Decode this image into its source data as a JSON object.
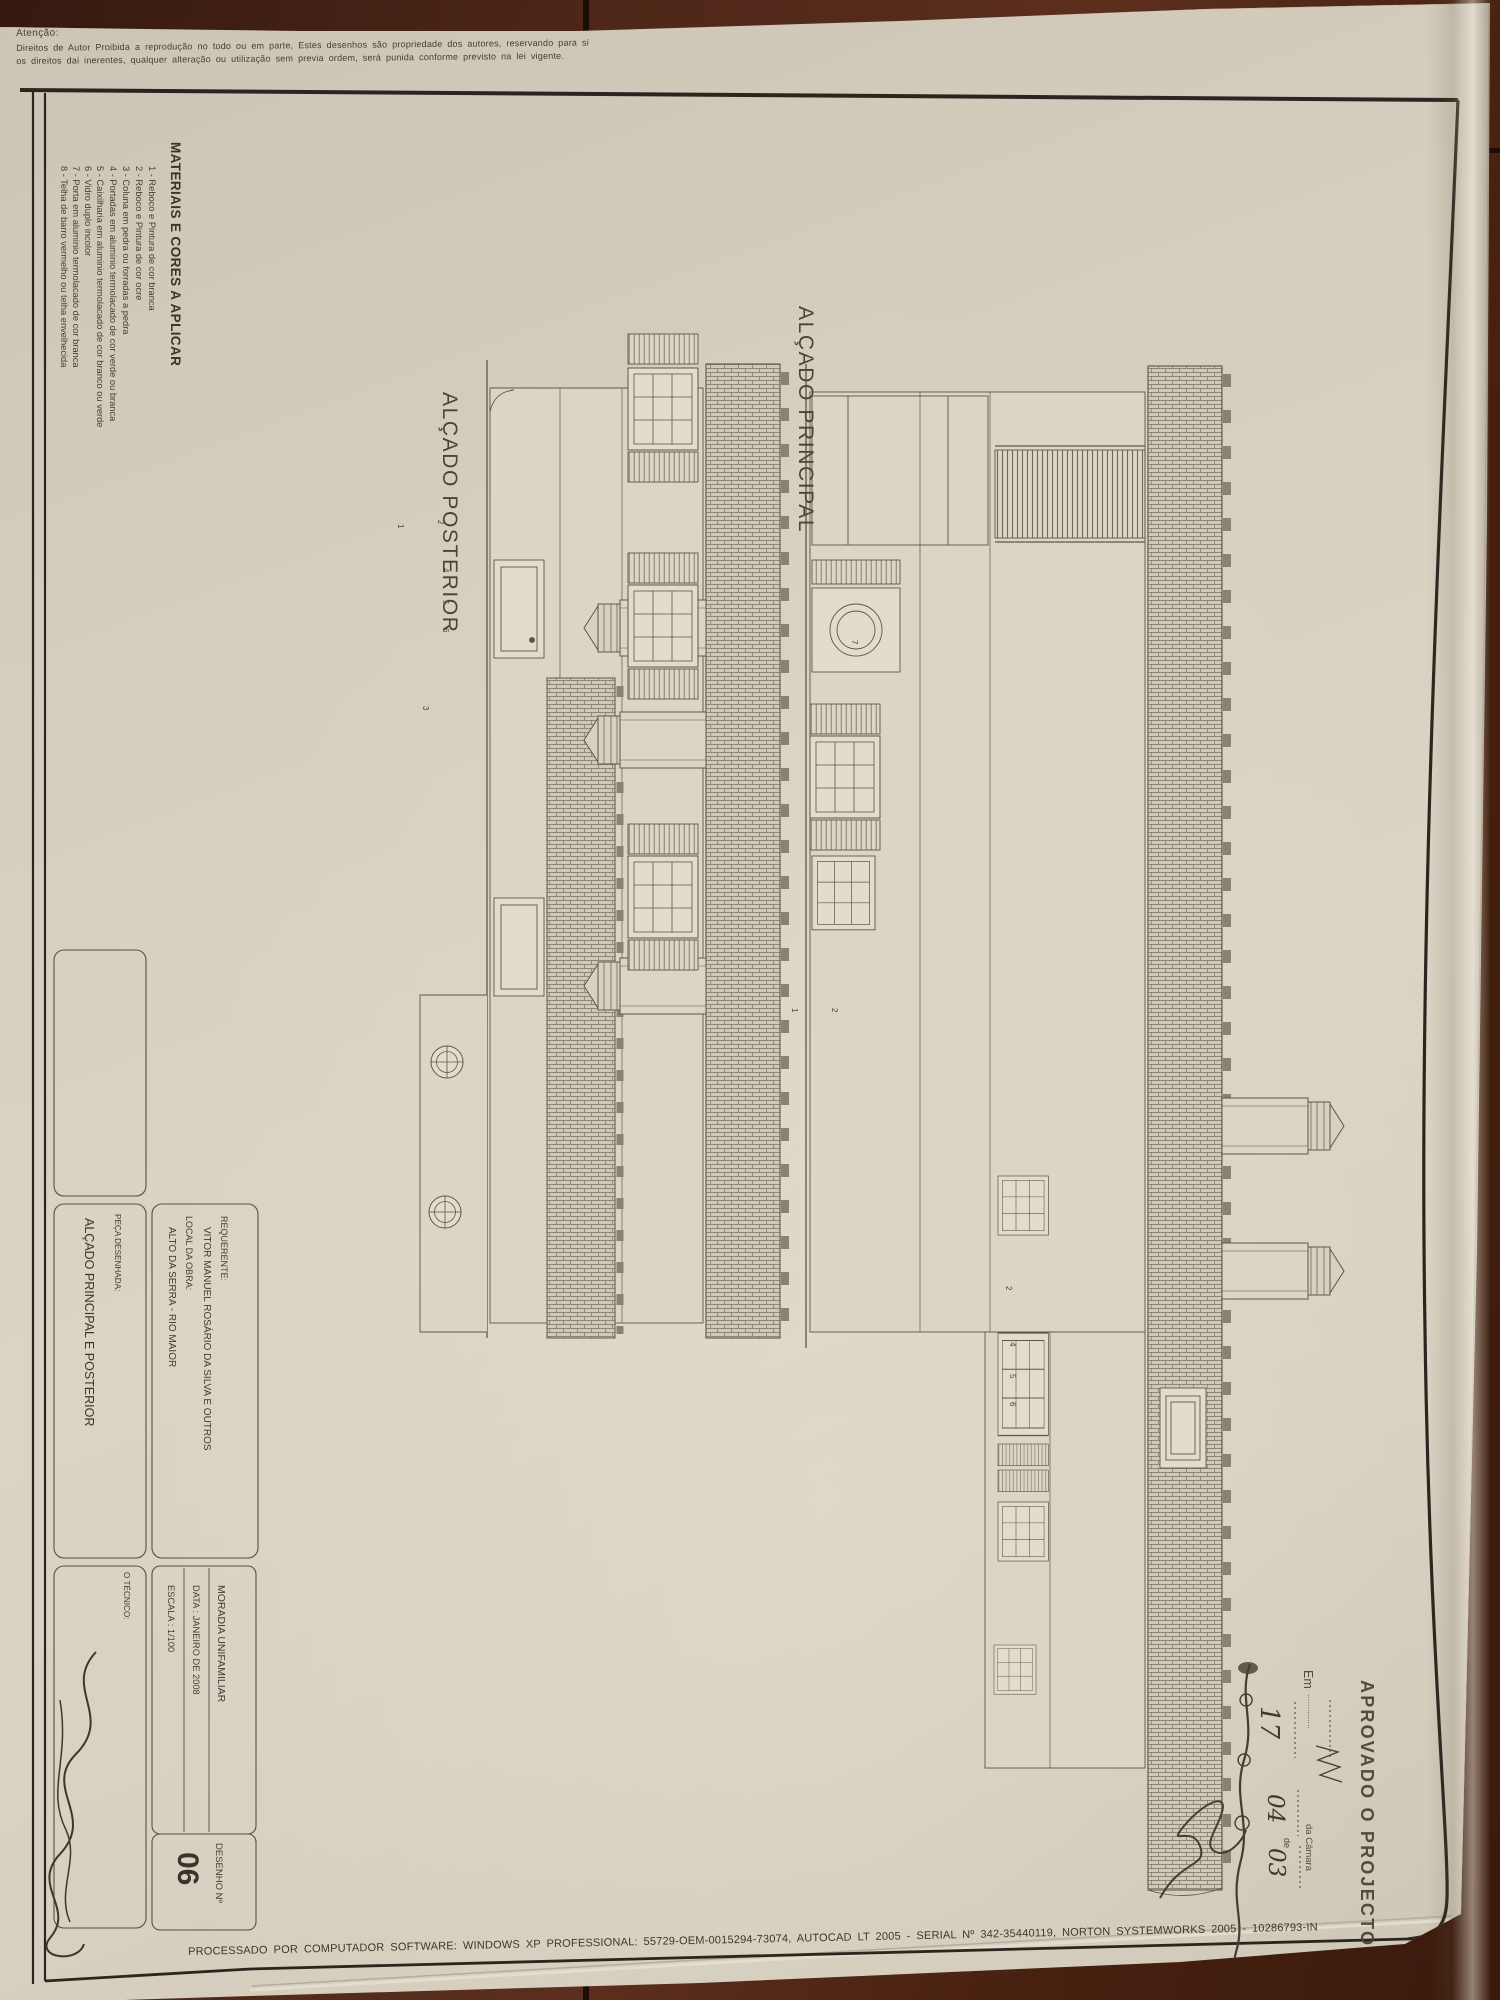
{
  "colors": {
    "paper": "#d7d0c1",
    "wood": "#4e2718",
    "ink": "#3e382f",
    "frame": "#2b2520",
    "stamp_ink": "#474136"
  },
  "copyright": {
    "heading": "Atenção:",
    "line1": "Direitos de Autor Proibida a reprodução no todo ou em parte, Estes desenhos são propriedade dos autores, reservando para si",
    "line2": "os direitos dai inerentes, qualquer alteração ou utilização sem previa ordem, será punida conforme previsto na lei vigente."
  },
  "materials": {
    "title": "MATERIAIS E CORES A APLICAR",
    "items": [
      "1 - Reboco e Pintura de cor branca",
      "2 - Reboco e Pintura de cor ocre",
      "3 - Coluna em pedra ou forradas a pedra",
      "4 - Portadas em aluminio termolacado de cor verde ou branca",
      "5 - Caixilharia em aluminio termolacado de cor branco ou verde",
      "6 - Vidro duplo incolor",
      "7 - Porta em aluminio termolacado de cor branca",
      "8 - Telha de barro vermelho ou telha envelhecida"
    ]
  },
  "elevations": {
    "posterior_label": "ALÇADO POSTERIOR",
    "principal_label": "ALÇADO PRINCIPAL"
  },
  "titleblock": {
    "requerente_label": "REQUERENTE:",
    "requerente": "VITOR MANUEL ROSÁRIO DA SILVA E OUTROS",
    "local_label": "LOCAL DA OBRA:",
    "local": "ALTO DA SERRA - RIO MAIOR",
    "project": "MORADIA UNIFAMILIAR",
    "date": "DATA : JANEIRO DE 2008",
    "scale": "ESCALA : 1/100",
    "peca_label": "PEÇA DESENHADA:",
    "peca": "ALÇADO PRINCIPAL E POSTERIOR",
    "tecnico_label": "O TÉCNICO:",
    "number_label": "DESENHO  Nº",
    "number": "06"
  },
  "stamp": {
    "title": "APROVADO O PROJECTO",
    "em_label": "Em",
    "dots": "..............",
    "camara": "da Câmara",
    "de_label": "de",
    "day": "17",
    "month": "04",
    "year": "03"
  },
  "footer": {
    "processing": "PROCESSADO POR COMPUTADOR SOFTWARE: WINDOWS XP PROFESSIONAL: 55729-OEM-0015294-73074, AUTOCAD LT 2005 - SERIAL Nº 342-35440119, NORTON SYSTEMWORKS 2005 - 10286793-IN"
  },
  "annotations": {
    "posterior_digits": [
      "1",
      "2",
      "4",
      "5",
      "6",
      "3"
    ],
    "principal_digits": [
      "7",
      "1",
      "2",
      "2",
      "4",
      "5",
      "6"
    ]
  }
}
